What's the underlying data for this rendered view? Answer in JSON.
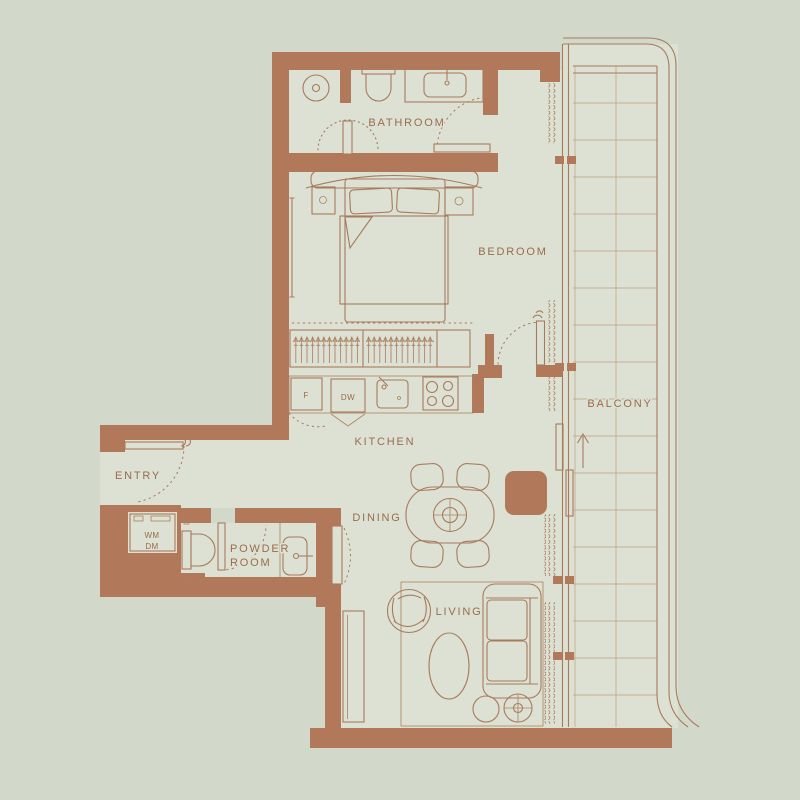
{
  "floor_plan": {
    "rooms": {
      "bathroom": {
        "label": "BATHROOM"
      },
      "bedroom": {
        "label": "BEDROOM"
      },
      "balcony": {
        "label": "BALCONY"
      },
      "kitchen": {
        "label": "KITCHEN"
      },
      "entry": {
        "label": "ENTRY"
      },
      "powder_room": {
        "label_line_1": "POWDER",
        "label_line_2": "ROOM"
      },
      "dining": {
        "label": "DINING"
      },
      "living": {
        "label": "LIVING"
      }
    },
    "appliances": {
      "fridge": {
        "label": "F"
      },
      "dishwasher": {
        "label": "DW"
      },
      "washer": {
        "label": "WM"
      },
      "dryer": {
        "label": "DM"
      }
    },
    "colors": {
      "background": "#d3d9ca",
      "floor": "#dce1d3",
      "wall": "#b1795a",
      "line": "#a87a5c",
      "label": "#9c6b4c"
    }
  }
}
